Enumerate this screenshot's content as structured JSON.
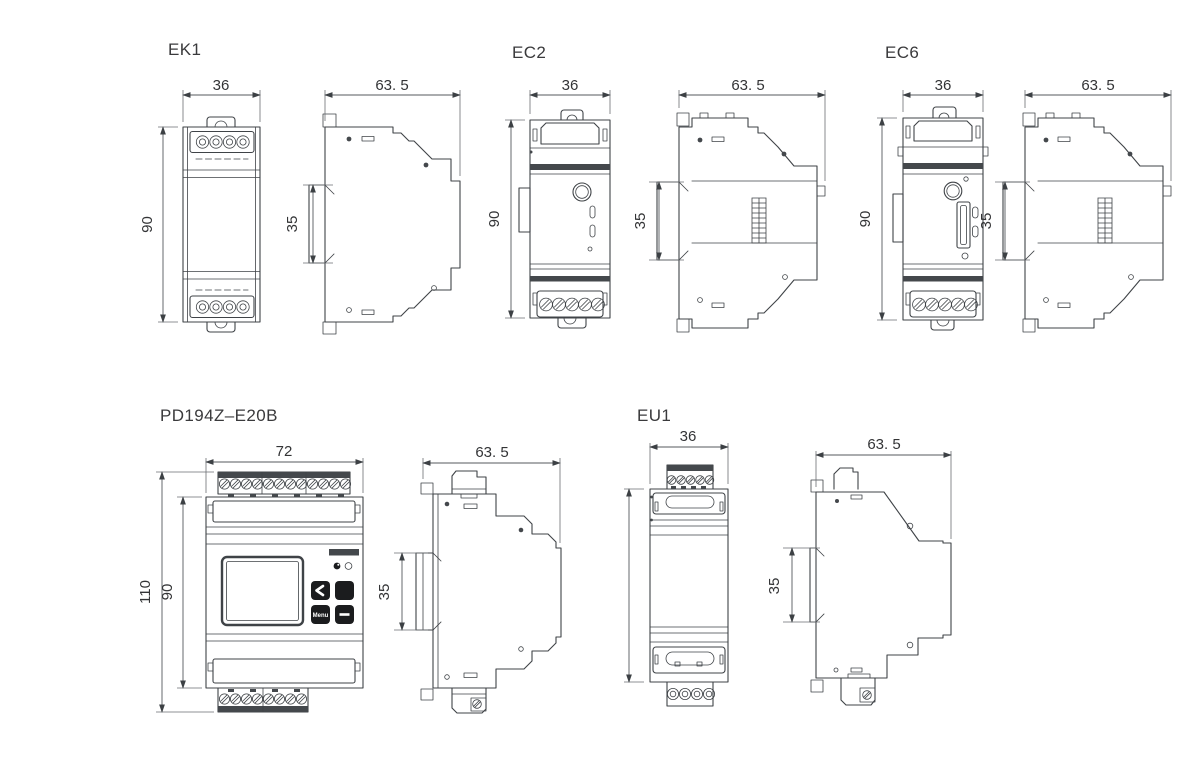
{
  "page": {
    "background": "#ffffff"
  },
  "colors": {
    "line": "#3f4347",
    "dimension_line": "#54585c",
    "text": "#3a3a3c",
    "dark_band": "#44484c",
    "button_fill": "#1b1c1e"
  },
  "devices": [
    {
      "id": "ek1",
      "title": "EK1",
      "dim_width": "36",
      "dim_height": "90",
      "dim_depth": "63. 5",
      "dim_rail_height": "35"
    },
    {
      "id": "ec2",
      "title": "EC2",
      "dim_width": "36",
      "dim_height": "90",
      "dim_depth": "63. 5",
      "dim_rail_height": "35"
    },
    {
      "id": "ec6",
      "title": "EC6",
      "dim_width": "36",
      "dim_height": "90",
      "dim_depth": "63. 5",
      "dim_rail_height": "35"
    },
    {
      "id": "pd194z-e20b",
      "title": "PD194Z–E20B",
      "dim_width": "72",
      "dim_height_total": "110",
      "dim_height_body": "90",
      "dim_depth": "63. 5",
      "dim_rail_height": "35",
      "panel": {
        "menu_button_label": "Menu",
        "icons": [
          "chevron-left-icon",
          "minus-icon"
        ]
      }
    },
    {
      "id": "eu1",
      "title": "EU1",
      "dim_width": "36",
      "dim_depth": "63. 5",
      "dim_rail_height": "35"
    }
  ]
}
